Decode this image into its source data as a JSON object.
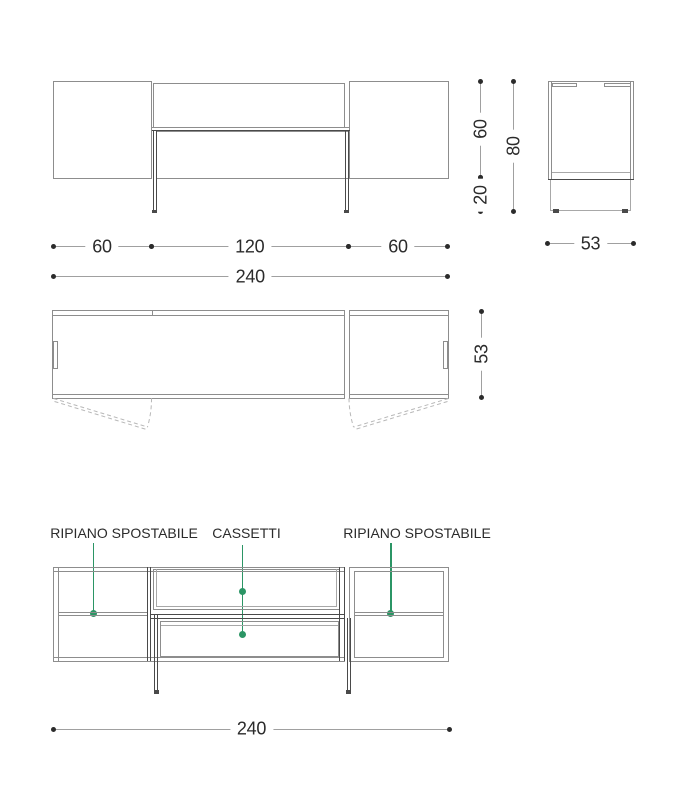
{
  "colors": {
    "accent_green": "#2b9565",
    "line_dark": "#4a4a4a",
    "line_light": "#8d8d8d"
  },
  "dims": {
    "front_left": "60",
    "front_center": "120",
    "front_right": "60",
    "front_total": "240",
    "side_body_height": "60",
    "side_leg_height": "20",
    "side_total_height": "80",
    "side_depth": "53",
    "plan_depth": "53",
    "internal_total": "240"
  },
  "labels": {
    "shelf_left": "RIPIANO SPOSTABILE",
    "drawers": "CASSETTI",
    "shelf_right": "RIPIANO SPOSTABILE"
  }
}
